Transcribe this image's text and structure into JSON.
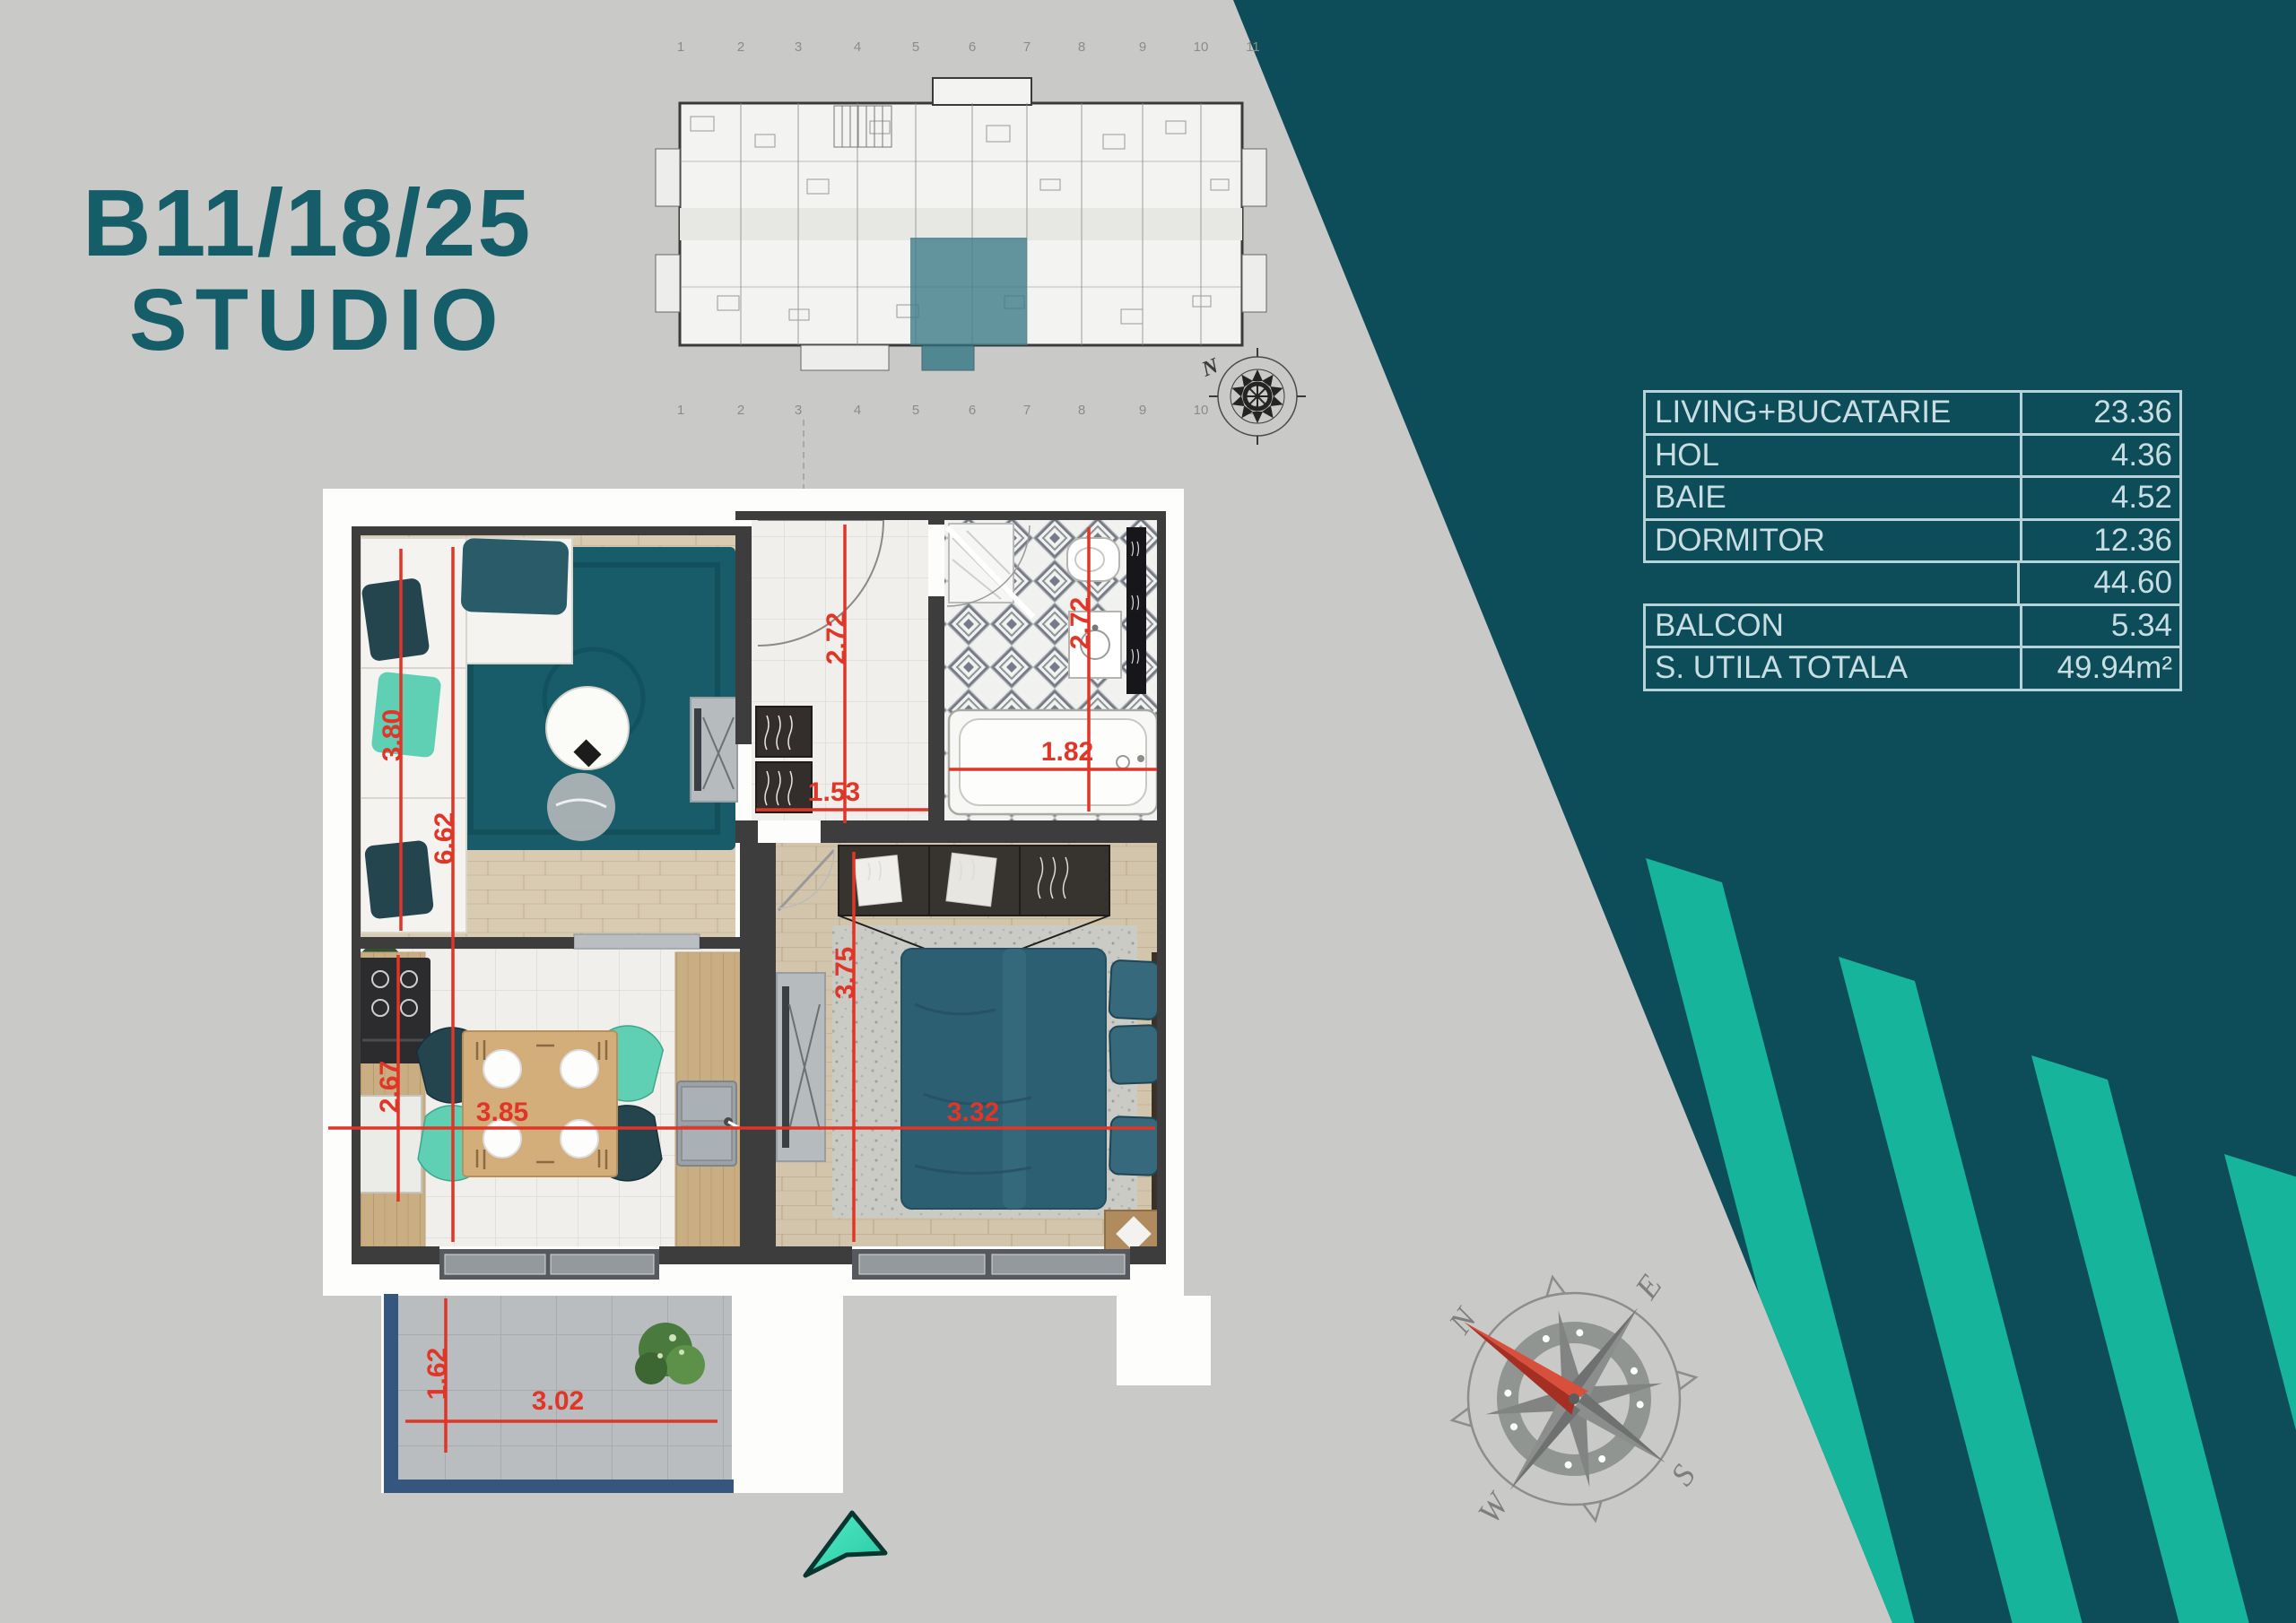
{
  "title": {
    "line1": "B11/18/25",
    "line2": "STUDIO"
  },
  "areas_table": {
    "rows": [
      {
        "label": "LIVING+BUCATARIE",
        "value": "23.36"
      },
      {
        "label": "HOL",
        "value": "4.36"
      },
      {
        "label": "BAIE",
        "value": "4.52"
      },
      {
        "label": "DORMITOR",
        "value": "12.36"
      },
      {
        "label": "",
        "value": "44.60"
      },
      {
        "label": "BALCON",
        "value": "5.34"
      },
      {
        "label": "S. UTILA TOTALA",
        "value": "49.94m²"
      }
    ]
  },
  "floor_plan": {
    "dims": {
      "living_h": "3.80",
      "total_h": "6.62",
      "hall_h": "2.72",
      "hall_w": "1.53",
      "bath_w": "1.82",
      "bath_h": "2.72",
      "kitchen_h": "2.67",
      "kitchen_w": "3.85",
      "bedroom_h": "3.75",
      "bedroom_w": "3.32",
      "balcony_h": "1.62",
      "balcony_w": "3.02"
    }
  },
  "building_plan": {
    "grid_numbers": [
      "1",
      "2",
      "3",
      "4",
      "5",
      "6",
      "7",
      "8",
      "9",
      "10",
      "11"
    ]
  },
  "compass": {
    "n": "N",
    "e": "E",
    "s": "S",
    "w": "W"
  },
  "small_compass": {
    "n": "N"
  },
  "colors": {
    "background": "#c9cac8",
    "wedge_teal": "#0d4d59",
    "stripe_green": "#16b49a",
    "title_teal": "#155d68",
    "dimension_red": "#e03527",
    "table_text": "#c9dee3",
    "table_border": "#b7d2d8",
    "highlight_unit_teal": "#3d7c88",
    "balcony_outline_blue": "#35567e",
    "marker_teal": "#3fe3bd"
  }
}
